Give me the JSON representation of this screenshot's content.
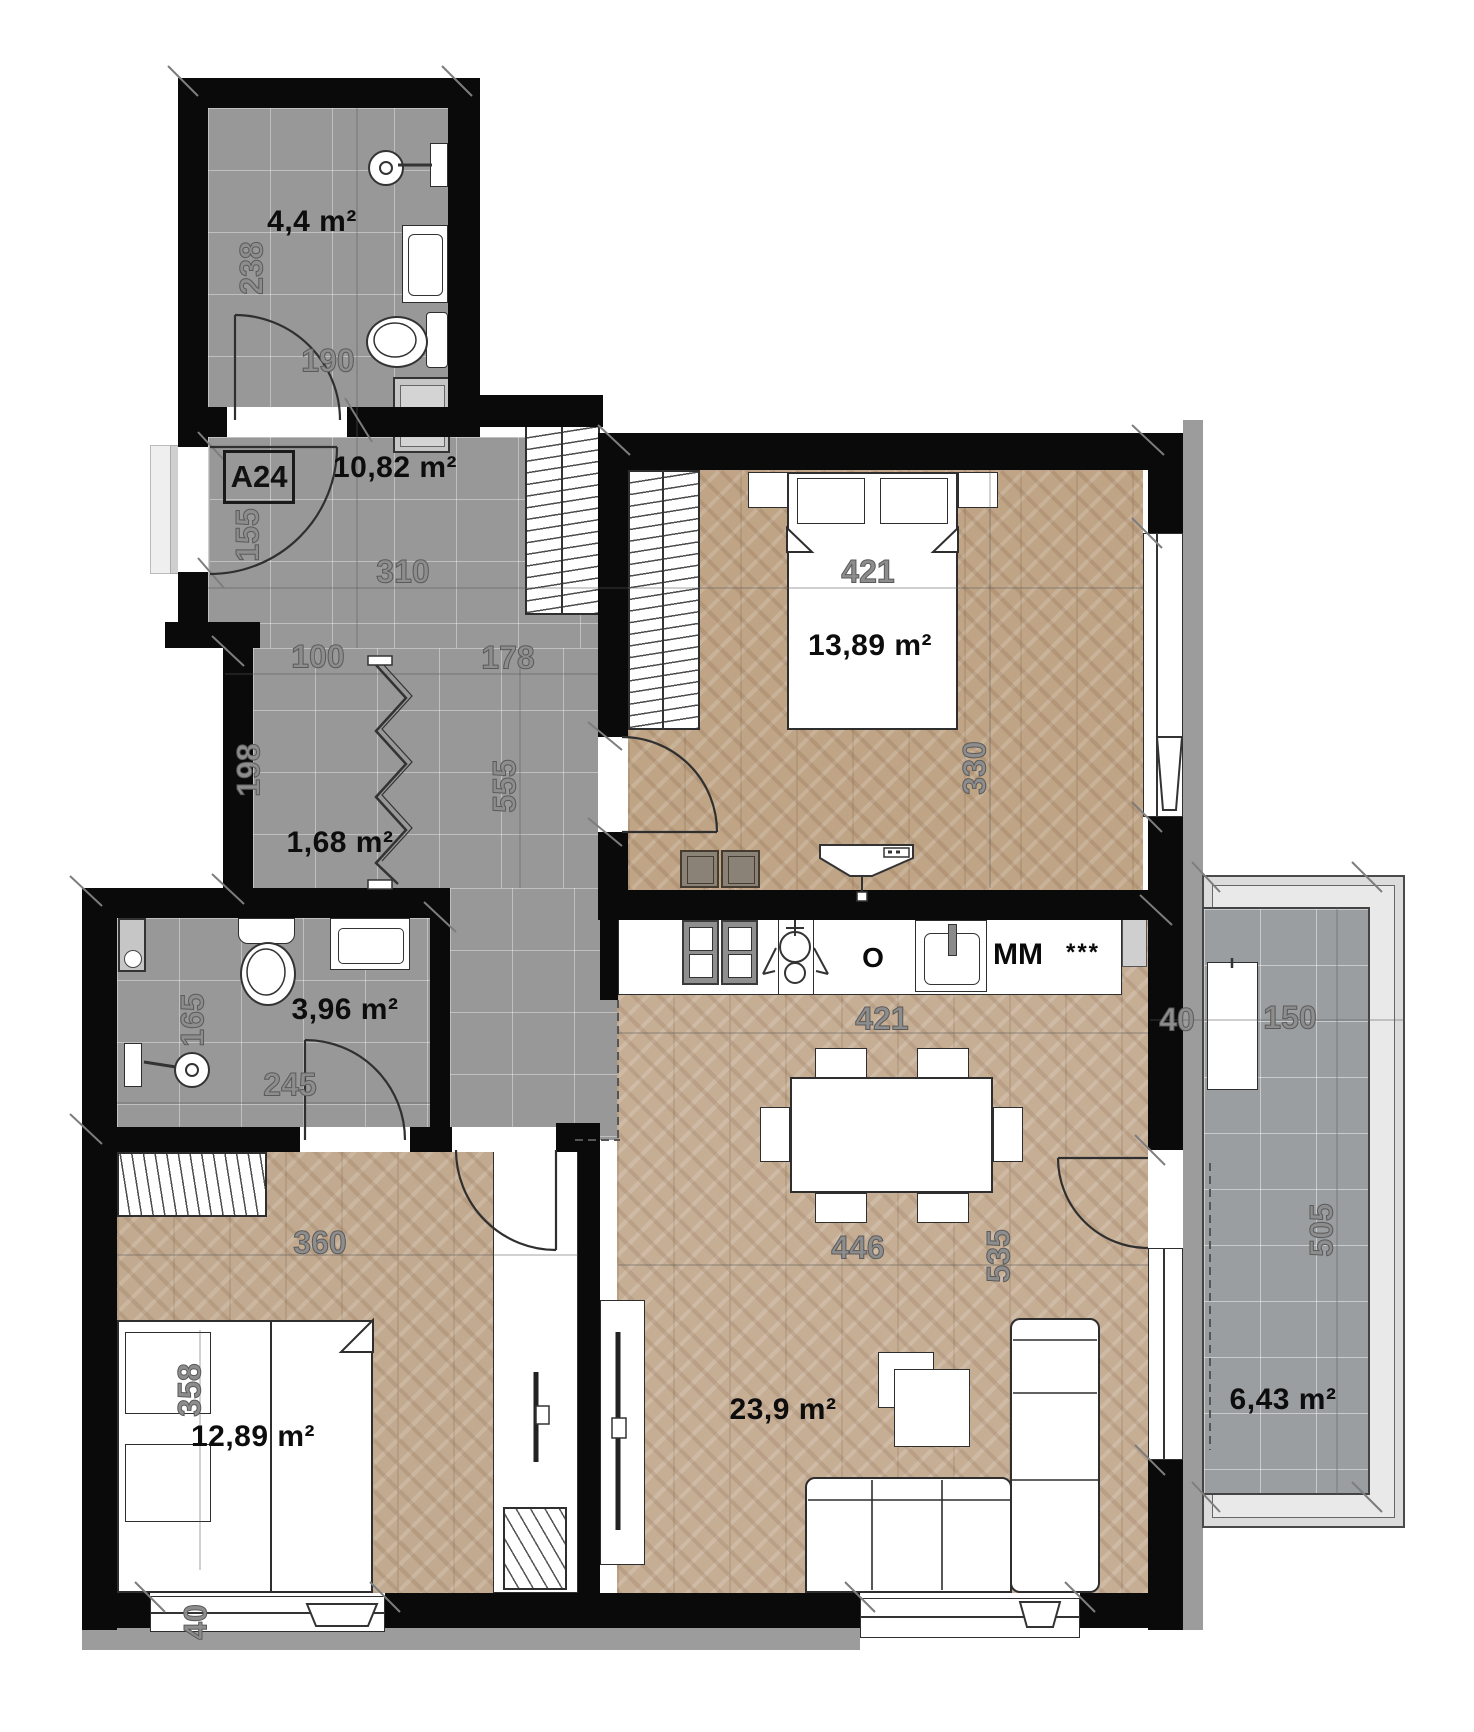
{
  "unit": {
    "label": "A24"
  },
  "rooms": {
    "bathroom_top": {
      "area": "4,4 m²"
    },
    "entry_hall": {
      "area": "10,82 m²"
    },
    "corridor": {
      "area": "1,68 m²"
    },
    "bathroom_small": {
      "area": "3,96 m²"
    },
    "bedroom_right": {
      "area": "13,89 m²"
    },
    "bedroom_left": {
      "area": "12,89 m²"
    },
    "living_room": {
      "area": "23,9 m²"
    },
    "balcony": {
      "area": "6,43 m²"
    }
  },
  "dimensions": {
    "d238": "238",
    "d190": "190",
    "d155": "155",
    "d310": "310",
    "d100": "100",
    "d178": "178",
    "d198": "198",
    "d555": "555",
    "d165": "165",
    "d245": "245",
    "d421_bed": "421",
    "d330": "330",
    "d421_kitchen": "421",
    "d446": "446",
    "d535": "535",
    "d360": "360",
    "d358": "358",
    "d40_bedroom": "40",
    "d40_balcony": "40",
    "d150": "150",
    "d505": "505",
    "d6_43": "6,43 m²"
  },
  "kitchen": {
    "oven": "O",
    "microwave": "MM",
    "freezer": "***"
  },
  "colors": {
    "wall": "#0a0a0a",
    "tile": "#989898",
    "wood": "#c2aa90",
    "exterior": "#9c9c9c"
  }
}
